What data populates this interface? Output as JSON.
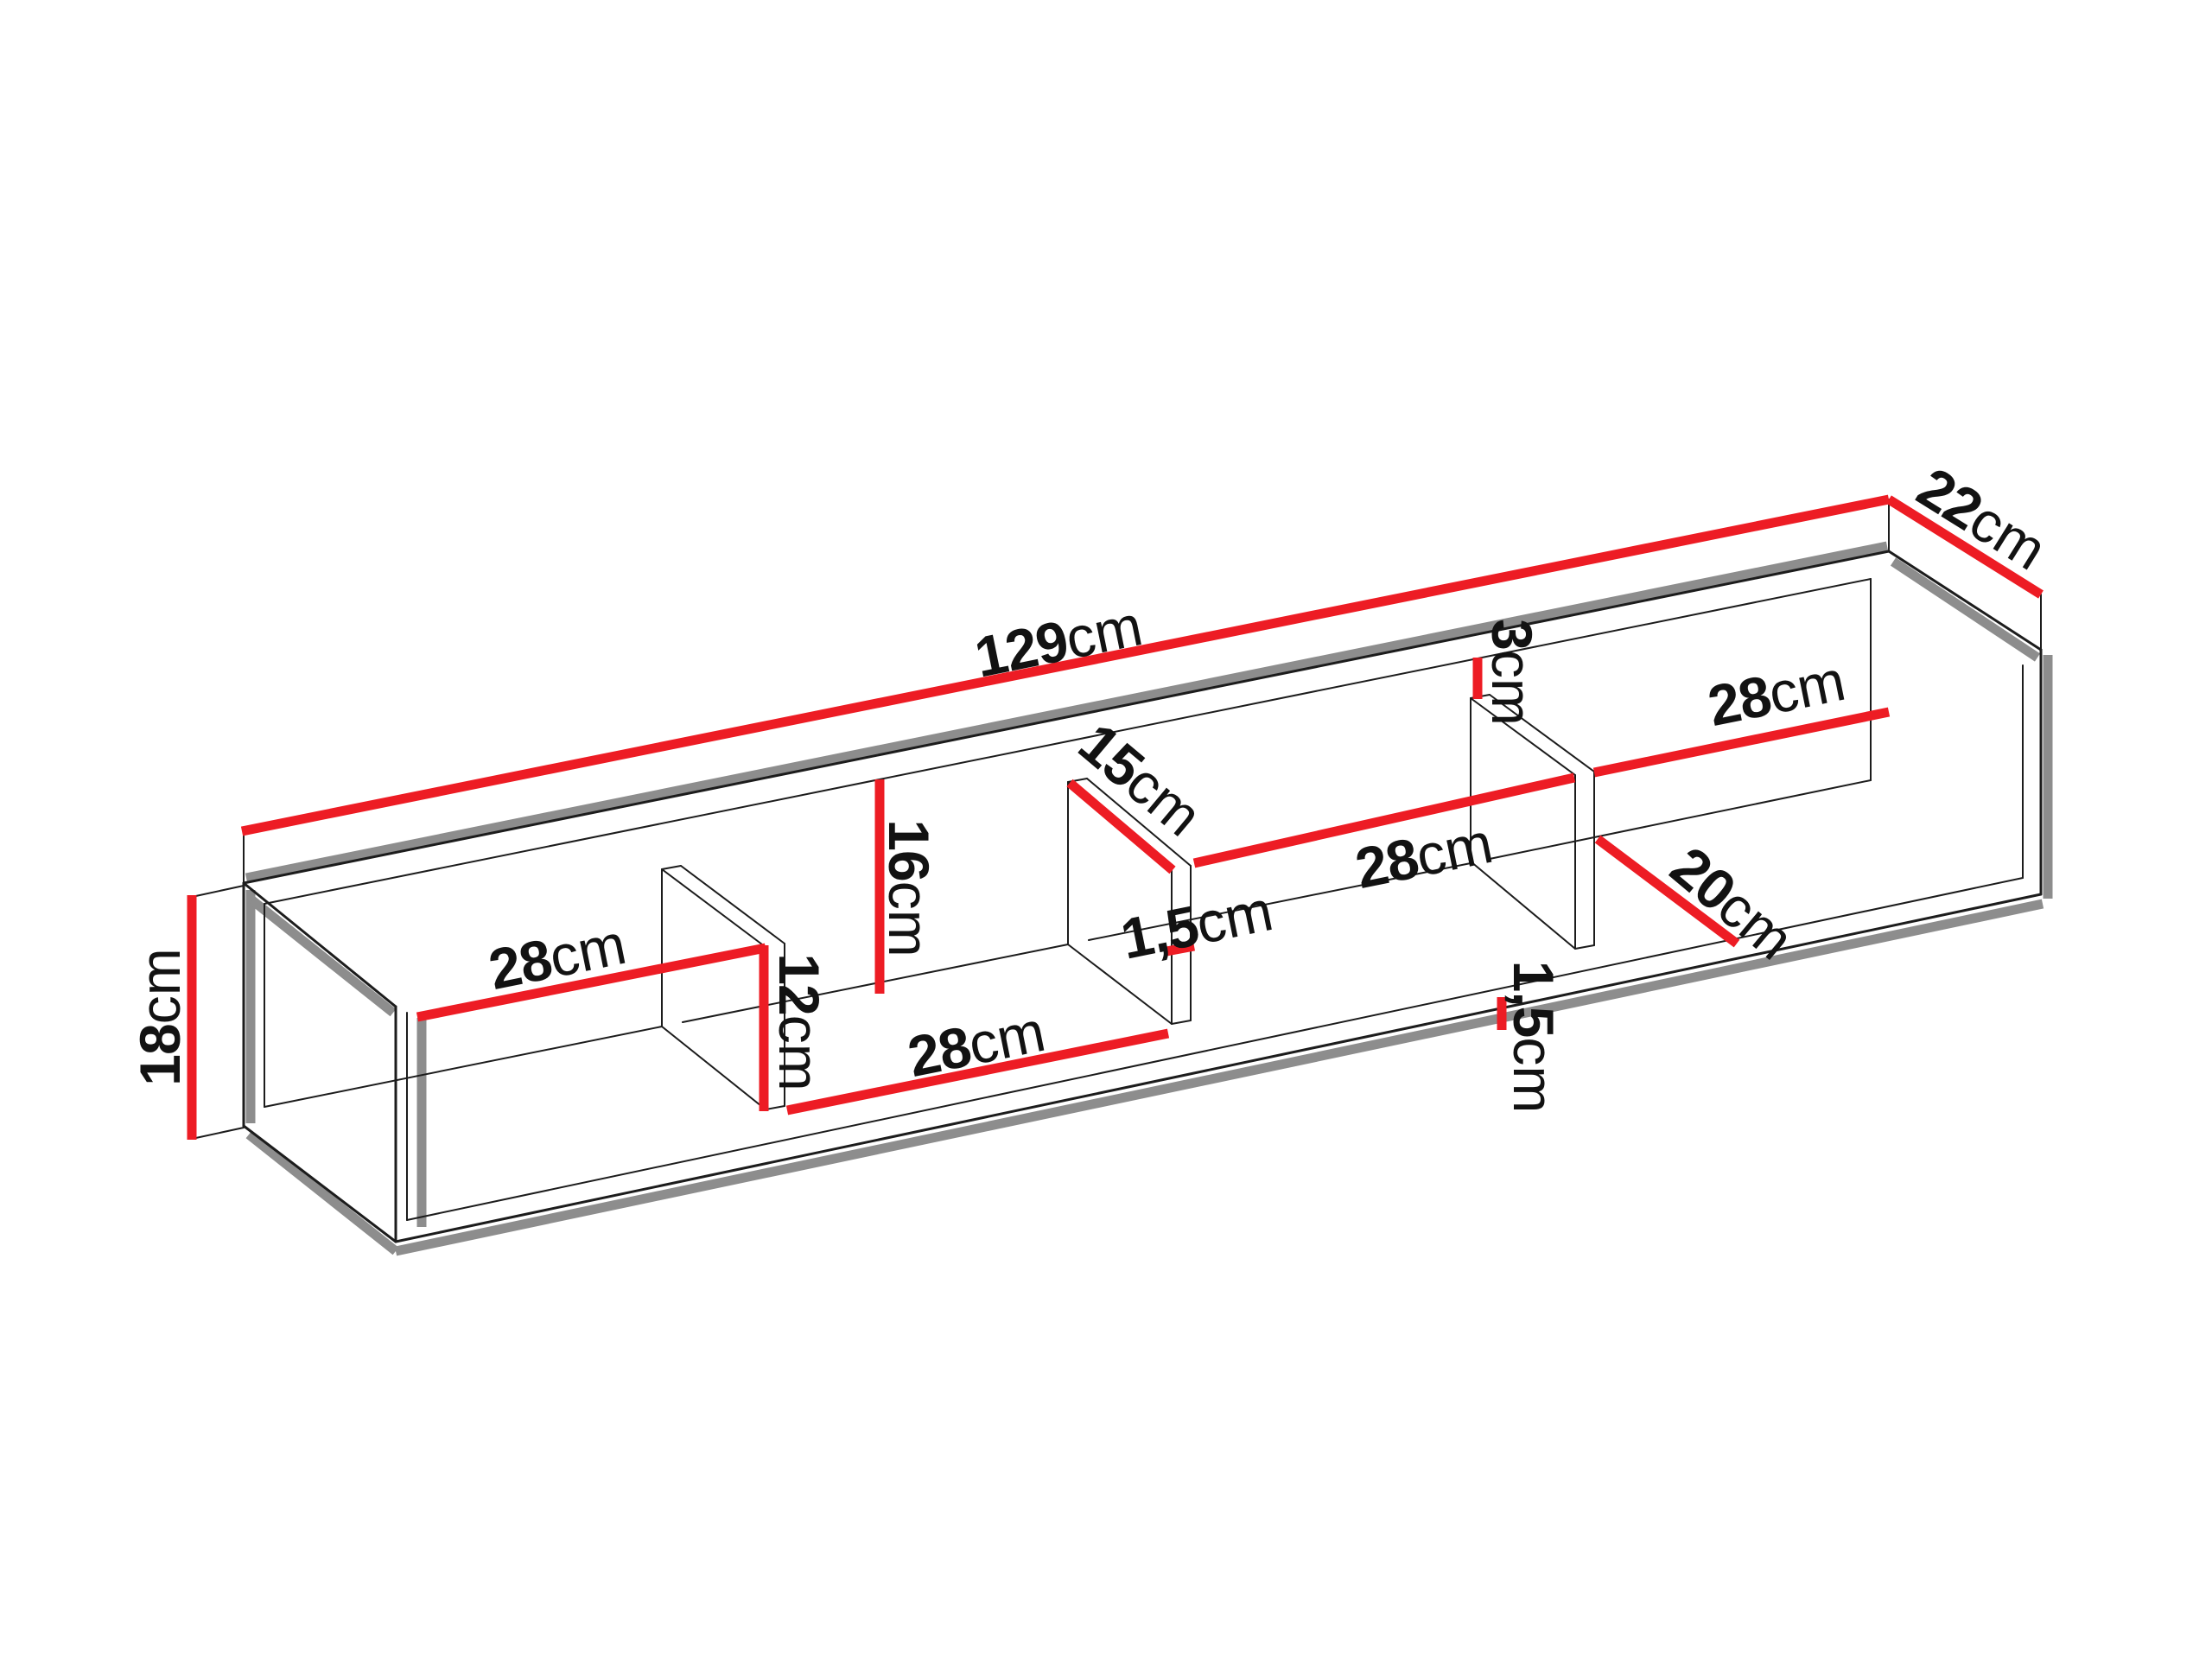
{
  "diagram": {
    "name": "wall-shelf-dimension-diagram",
    "unit_system": "cm",
    "colors": {
      "dimension": "#ed1c24",
      "shadow": "#8d8d8d",
      "line": "#1c1c1c",
      "background": "#ffffff"
    },
    "overall_dimensions": {
      "width_cm": 129,
      "depth_cm": 22,
      "height_cm": 18
    },
    "labels": {
      "overall_width": {
        "num": "129",
        "unit": "cm"
      },
      "overall_depth": {
        "num": "22",
        "unit": "cm"
      },
      "overall_height": {
        "num": "18",
        "unit": "cm"
      },
      "compartment1_width": {
        "num": "28",
        "unit": "cm"
      },
      "divider1_height": {
        "num": "12",
        "unit": "cm"
      },
      "compartment2_height": {
        "num": "16",
        "unit": "cm"
      },
      "compartment2_width": {
        "num": "28",
        "unit": "cm"
      },
      "divider2_depth": {
        "num": "15",
        "unit": "cm"
      },
      "divider2_thickness": {
        "num": "1,5",
        "unit": "cm"
      },
      "divider3_top_gap": {
        "num": "3",
        "unit": "cm"
      },
      "compartment3_width": {
        "num": "28",
        "unit": "cm"
      },
      "compartment4_width": {
        "num": "28",
        "unit": "cm"
      },
      "compartment4_floor_depth": {
        "num": "20",
        "unit": "cm"
      },
      "bottom_panel_thickness": {
        "num": "1,5",
        "unit": "cm"
      }
    }
  }
}
